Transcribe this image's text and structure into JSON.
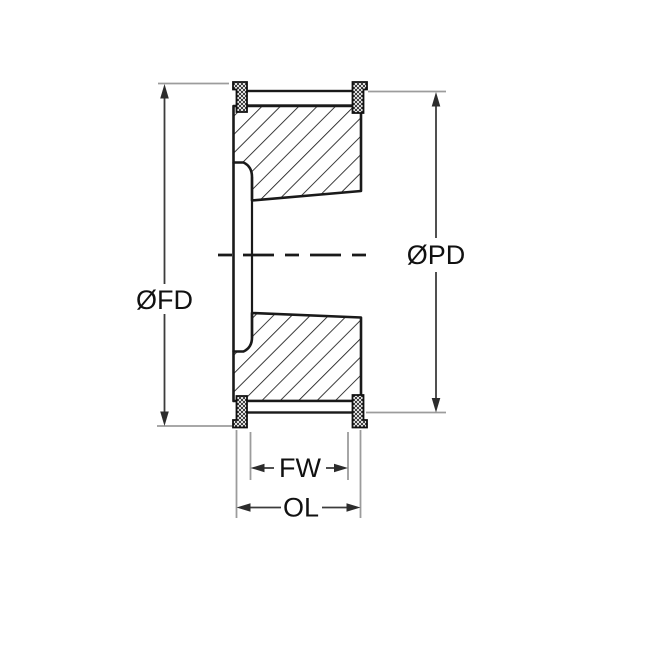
{
  "drawing": {
    "title": "timing-pulley-cross-section",
    "background_color": "#ffffff",
    "colors": {
      "outline": "#1a1a1a",
      "hatch": "#1a1a1a",
      "flange_fill": "#111111",
      "dimension_line": "#3c3c3c",
      "extension_line": "#9c9c9c",
      "label_text": "#111111"
    },
    "labels": {
      "fd": "ØFD",
      "pd": "ØPD",
      "fw": "FW",
      "ol": "OL"
    },
    "dimension_count": "4",
    "dimension_list": [
      {
        "label": "ØFD",
        "orientation": "vertical",
        "side": "left"
      },
      {
        "label": "ØPD",
        "orientation": "vertical",
        "side": "right"
      },
      {
        "label": "FW",
        "orientation": "horizontal",
        "side": "bottom"
      },
      {
        "label": "OL",
        "orientation": "horizontal",
        "side": "bottom"
      }
    ]
  }
}
